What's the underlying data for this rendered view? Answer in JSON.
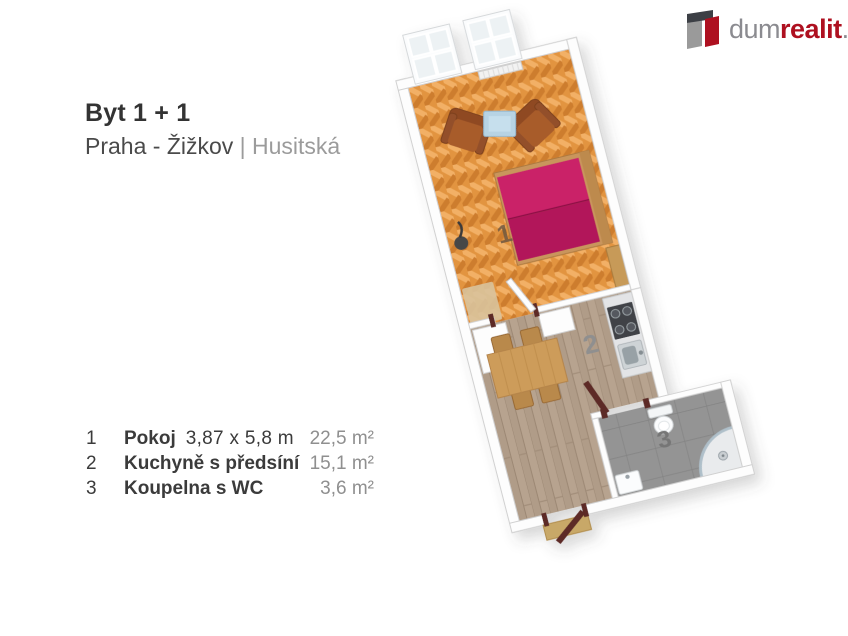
{
  "brand": {
    "part_gray1": "dum",
    "part_red": "realit",
    "part_gray2": ".cz"
  },
  "header": {
    "title": "Byt 1 + 1",
    "city": "Praha - Žižkov",
    "divider": "|",
    "street": "Husitská"
  },
  "legend": [
    {
      "number": "1",
      "name": "Pokoj",
      "dimensions": "3,87 x 5,8 m",
      "area": "22,5 m²"
    },
    {
      "number": "2",
      "name": "Kuchyně s předsíní",
      "dimensions": "",
      "area": "15,1 m²"
    },
    {
      "number": "3",
      "name": "Koupelna s WC",
      "dimensions": "",
      "area": "3,6 m²"
    }
  ],
  "floorplan": {
    "rooms": [
      {
        "number": "1"
      },
      {
        "number": "2"
      },
      {
        "number": "3"
      }
    ],
    "colors": {
      "logo_red": "#ae1020",
      "logo_gray": "#8b8b90",
      "parquet_orange": "#e2943f",
      "bed_magenta": "#c32065",
      "kitchen_floor": "#b09c88",
      "bath_tile_gray": "#959595",
      "wood_furniture": "#cd9c5a",
      "armchair_brown": "#9a5428",
      "door_frame_brown": "#5d2a28",
      "wall_white": "#fdfdfd"
    }
  }
}
